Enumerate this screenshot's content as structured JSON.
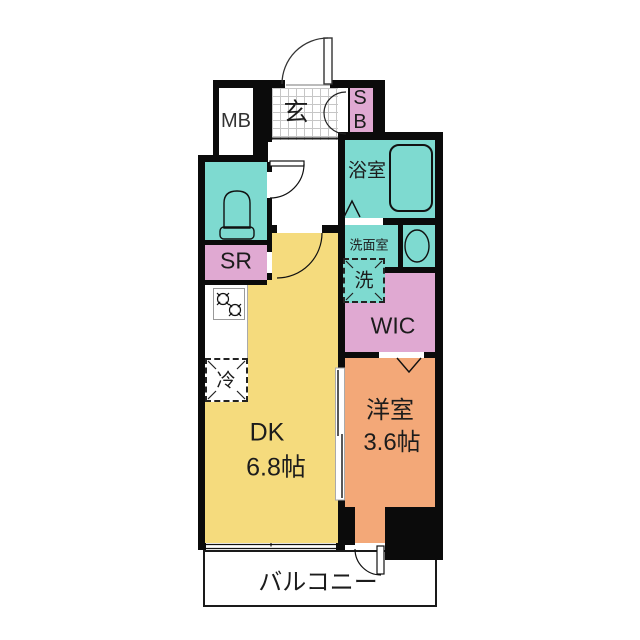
{
  "page": {
    "type": "japanese-apartment-floor-plan",
    "background": "#ffffff"
  },
  "colors": {
    "wall": "#0b0b0b",
    "wet_area_teal": "#7edad0",
    "storage_pink": "#e0a9d2",
    "dk_yellow": "#f5db7d",
    "room_orange": "#f3a878"
  },
  "rooms": {
    "meter_box": {
      "label": "MB"
    },
    "entrance": {
      "label": "玄"
    },
    "shoe_box": {
      "line1": "S",
      "line2": "B"
    },
    "bathroom": {
      "label": "浴室"
    },
    "washroom": {
      "label": "洗面室"
    },
    "washer": {
      "label": "洗"
    },
    "storage_room": {
      "label": "SR"
    },
    "walk_in_closet": {
      "label": "WIC"
    },
    "refrigerator": {
      "label": "冷"
    },
    "dining_kitchen": {
      "label": "DK",
      "size": "6.8帖"
    },
    "western_room": {
      "label": "洋室",
      "size": "3.6帖"
    },
    "balcony": {
      "label": "バルコニー"
    }
  },
  "symbols": {
    "entrance_door": "swing-door",
    "shoebox_door": "double-leaf-door",
    "toilet": "toilet-fixture",
    "bathtub": "bathtub",
    "sink": "wash-basin",
    "stove": "two-burner-stove",
    "window": "sliding-window",
    "dk_western_door": "sliding-door",
    "bathroom_door": "folding-door-mark",
    "wic_door": "folding-door-mark",
    "balcony_door": "swing-door"
  }
}
